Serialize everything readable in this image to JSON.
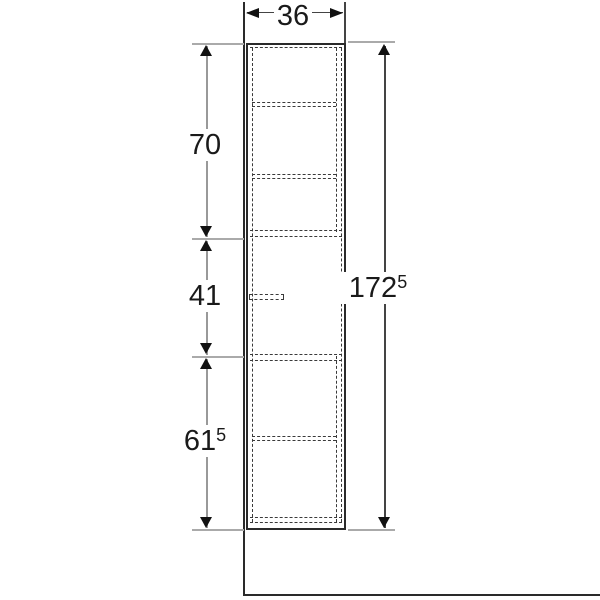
{
  "drawing": {
    "kind": "furniture-dimension-drawing",
    "dimensions": {
      "width": {
        "value": "36",
        "sup": ""
      },
      "total_height": {
        "value": "172",
        "sup": "5"
      },
      "sections": [
        {
          "value": "70",
          "sup": ""
        },
        {
          "value": "41",
          "sup": ""
        },
        {
          "value": "61",
          "sup": "5"
        }
      ]
    }
  },
  "colors": {
    "bg": "#ffffff",
    "line": "#2a2a2a",
    "dashed": "#3a3a3a",
    "dim": "#999999",
    "dimdark": "#444444",
    "ext": "#aaaaaa",
    "arrow": "#111111",
    "text": "#1a1a1a"
  }
}
